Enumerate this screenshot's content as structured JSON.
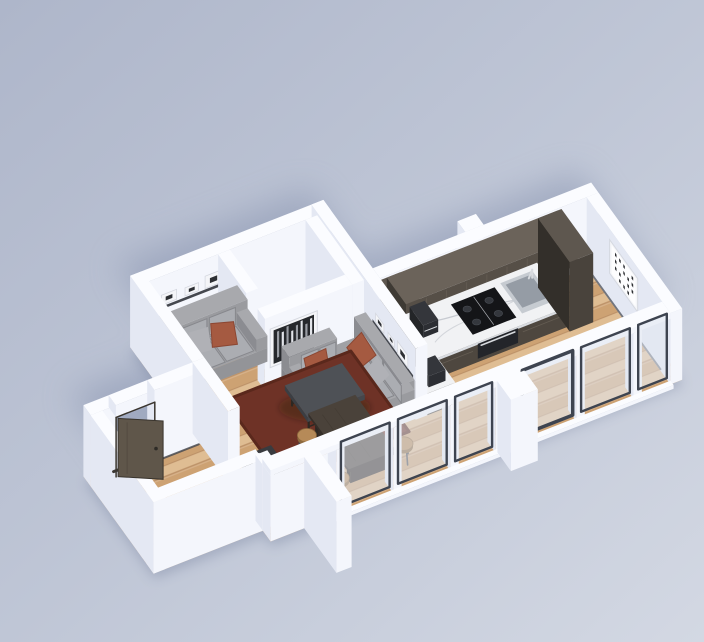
{
  "scene": {
    "title": "3D isometric render of a small studio apartment floor plan, viewed from above on a pale blue-grey backdrop",
    "style": "architectural dollhouse render, white walls, light oak floor, charcoal and rust accents",
    "rooms": [
      {
        "name": "entry hall",
        "features": [
          "dark wooden front door ajar",
          "white partition wall"
        ]
      },
      {
        "name": "living room",
        "features": [
          "two grey fabric sofas with rust pillows",
          "dark red rug",
          "charcoal coffee table",
          "black low sideboard",
          "dark wall shelves with white picture frames",
          "black and white birch artwork"
        ]
      },
      {
        "name": "storage nook",
        "features": [
          "small empty alcove with pale floor"
        ]
      },
      {
        "name": "kitchen",
        "features": [
          "dark wood galley cabinets",
          "white marble countertop",
          "black induction cooktop",
          "stainless sink with faucet",
          "built-in oven",
          "espresso machine",
          "tall cabinet columns",
          "return counter with appliance"
        ]
      },
      {
        "name": "dining area",
        "features": [
          "dark wood dining table",
          "five round wooden stools"
        ]
      },
      {
        "name": "hallway",
        "features": [
          "white framed letter-print artwork",
          "wood floor"
        ]
      },
      {
        "name": "facade",
        "features": [
          "floor-to-ceiling glazing with white mullions and dark frames",
          "exterior wall fins",
          "soft cast shadow on backdrop"
        ]
      }
    ],
    "counts": {
      "sofas": 2,
      "stools": 5,
      "picture_frames_on_shelves": 6,
      "artworks": 2,
      "glazing_panels": 6
    }
  },
  "palette": {
    "bgTop": "#aeb6ca",
    "bgMid": "#bfc6d6",
    "bgBottom": "#d3d8e3",
    "shadow": "#8a95b1",
    "contactShadow": "#76819d",
    "wallTop": "#fbfcff",
    "wallSide": "#e4e8f3",
    "wallFace": "#f4f6fc",
    "woodA": "#d7b189",
    "woodB": "#cda273",
    "woodC": "#dfbd93",
    "woodGap": "#bd9268",
    "closetFloor": "#e9ebf2",
    "baseboard": "#41454e",
    "rug": "#6e3226",
    "rugEdge": "#5a281c",
    "sofaTop": "#a0a1a5",
    "sofaSide": "#85868b",
    "sofaFront": "#939498",
    "cushTop": "#a8a9ad",
    "cushSide": "#8b8c91",
    "cushFront": "#9a9b9f",
    "cushionFace": "#abadb2",
    "seam": "#87888d",
    "pillowRust": "#a55a41",
    "pillowRustEdge": "#8c4733",
    "pillowGray": "#b0b1b6",
    "shelf": "#45484f",
    "frameLight": "#f4f5f8",
    "frameTrim": "#d5d8e0",
    "frameDark": "#2d2f33",
    "artBg": "#26282c",
    "artBarLight": "#e2e4e9",
    "artBarMid": "#9a9da4",
    "cabTop": "#6b635a",
    "cabSide": "#3e3a34",
    "cabFront": "#564f47",
    "cabGrain": "#746b60",
    "tallTop": "#5e574f",
    "tallSide": "#332f2a",
    "tallFront": "#49433c",
    "baseTop": "#58514a",
    "baseSide": "#36322c",
    "baseFront": "#4e473f",
    "counterTop": "#f1f2f4",
    "counterEdge": "#d9dce1",
    "vein": "#bfc3ca",
    "cooktop": "#141518",
    "burner": "#34373d",
    "hobLine": "#cfd2d8",
    "steel": "#d7dade",
    "ovenFace": "#23252a",
    "sinkOuter": "#c6cbd1",
    "sinkInner": "#959ca5",
    "applianceTop": "#34363b",
    "applianceSide": "#232528",
    "applianceFront": "#2c2e33",
    "tableTop": "#4a423a",
    "tableSide": "#352e28",
    "tableLeg": "#2d2823",
    "stoolTop": "#b68a58",
    "stoolSide": "#8d693e",
    "stoolLeg": "#4a4d53",
    "sbTop": "#393b3f",
    "sbSide": "#232527",
    "sbFront": "#2e3034",
    "itemWhiteTop": "#f4f5f8",
    "itemWhiteSide": "#dfe2ea",
    "itemWhiteFront": "#ececf2",
    "doorFace": "#5f564a",
    "doorEdge": "#3a352e",
    "doorHandle": "#2e2b27",
    "glass": "rgba(226,231,241,0.55)",
    "glassFrame": "#3e4450"
  }
}
